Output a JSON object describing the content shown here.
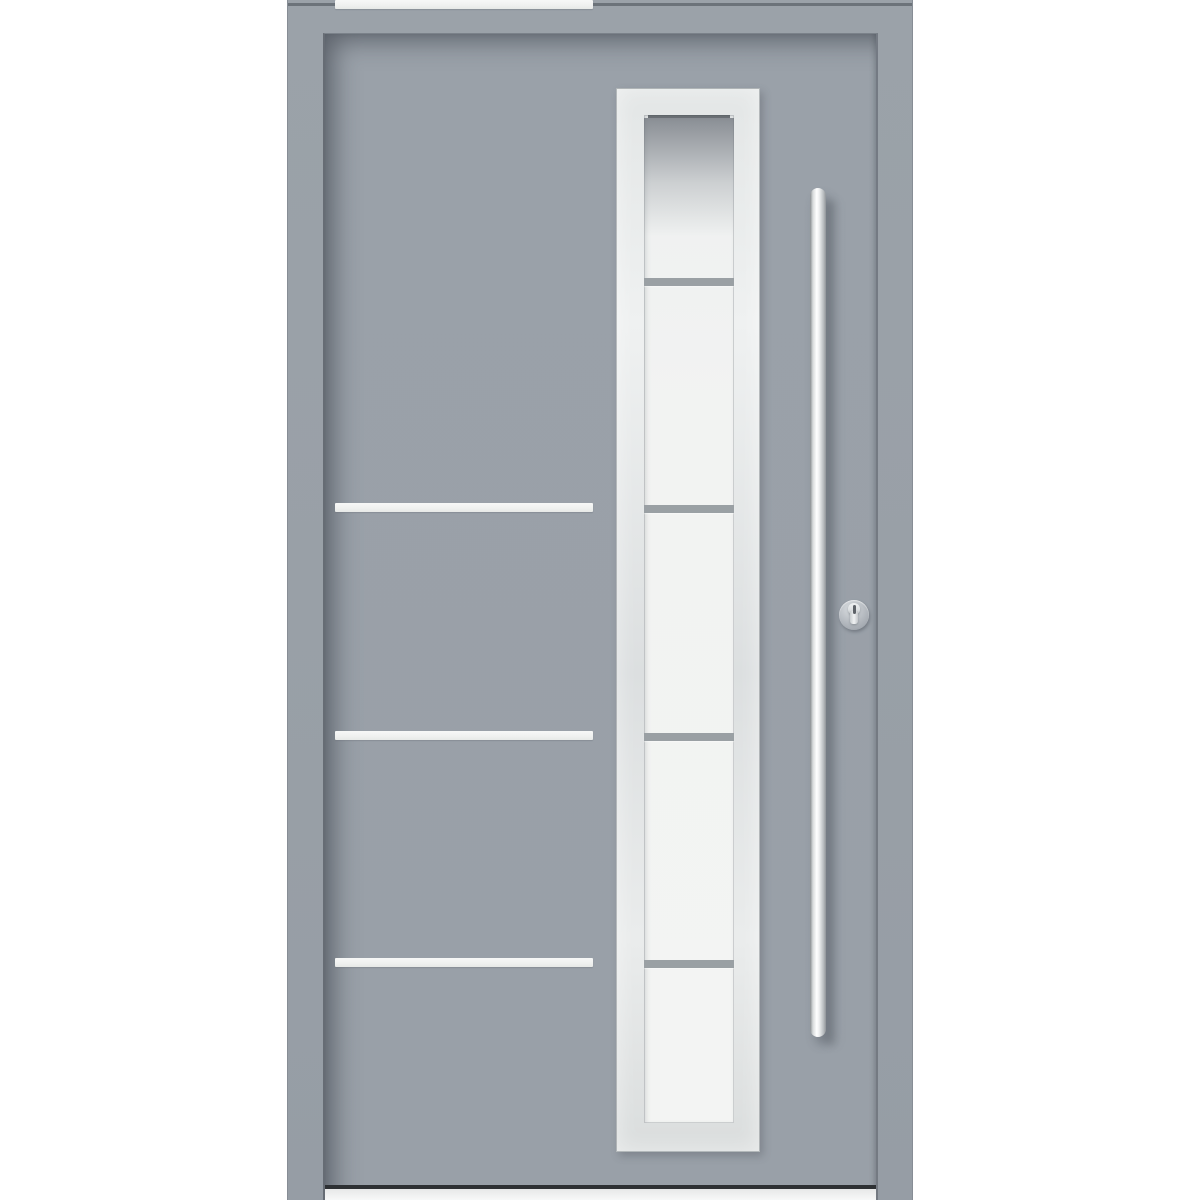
{
  "scene": {
    "description": "Product photo of a modern grey aluminium front entry door shown closed inside its matching grey frame on a white background",
    "background_color": "#ffffff"
  },
  "door": {
    "frame": {
      "color": "#99a0a7"
    },
    "leaf": {
      "color": "#9aa1a9"
    },
    "decor_strips": {
      "count": 4,
      "color": "#f0f1f0",
      "orientation": "horizontal",
      "note": "four stainless decor strips on the left half, aligned with the glazing dividers"
    },
    "glazing": {
      "pane_count": 5,
      "divider_count": 4,
      "frame_color": "#e0e3e3",
      "glass_color": "#f2f3f2",
      "divider_color": "#9aa0a4",
      "style": "vertical frosted glazing strip with brushed stainless surround, dark reflection at top pane"
    },
    "handle": {
      "type": "vertical-bar-pull",
      "material": "stainless-steel",
      "color": "#e9ebec"
    },
    "lock": {
      "type": "euro-profile-cylinder",
      "escutcheon_shape": "round",
      "color": "#b3b8be"
    },
    "threshold": {
      "color": "#f0f1f1"
    }
  }
}
